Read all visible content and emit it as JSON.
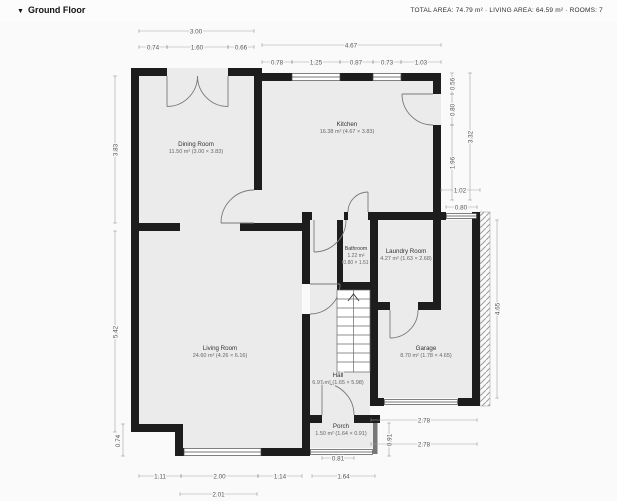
{
  "header": {
    "toggle": "▼",
    "title": "Ground Floor",
    "summary": "TOTAL AREA: 74.79 m² · LIVING AREA: 64.59 m² · ROOMS: 7"
  },
  "rooms": [
    {
      "name": "Dining Room",
      "area": "11.50 m² (3.00 × 3.83)"
    },
    {
      "name": "Kitchen",
      "area": "16.38 m² (4.67 × 3.83)"
    },
    {
      "name": "Living Room",
      "area": "24.60 m² (4.26 × 6.16)"
    },
    {
      "name": "Bathroom",
      "area": "1.22 m²",
      "size": "0.80 × 1.51"
    },
    {
      "name": "Laundry Room",
      "area": "4.27 m² (1.63 × 2.68)"
    },
    {
      "name": "Garage",
      "area": "8.70 m² (1.78 × 4.65)"
    },
    {
      "name": "Hall",
      "area": "6.97 m² (1.65 × 5.98)"
    },
    {
      "name": "Porch",
      "area": "1.50 m² (1.64 × 0.91)"
    }
  ],
  "dims": [
    "3.00",
    "0.74",
    "1.60",
    "0.66",
    "4.67",
    "0.78",
    "1.25",
    "0.87",
    "0.73",
    "1.03",
    "3.83",
    "5.42",
    "0.74",
    "0.56",
    "0.80",
    "1.96",
    "3.32",
    "1.02",
    "0.80",
    "4.65",
    "0.91",
    "2.78",
    "2.78",
    "1.11",
    "2.00",
    "1.14",
    "2.01",
    "0.81",
    "1.64"
  ],
  "colors": {
    "wall": "#1d1d1d",
    "room_fill": "#ebebeb",
    "background": "#fafafa",
    "dimension": "#8a8a8a"
  }
}
